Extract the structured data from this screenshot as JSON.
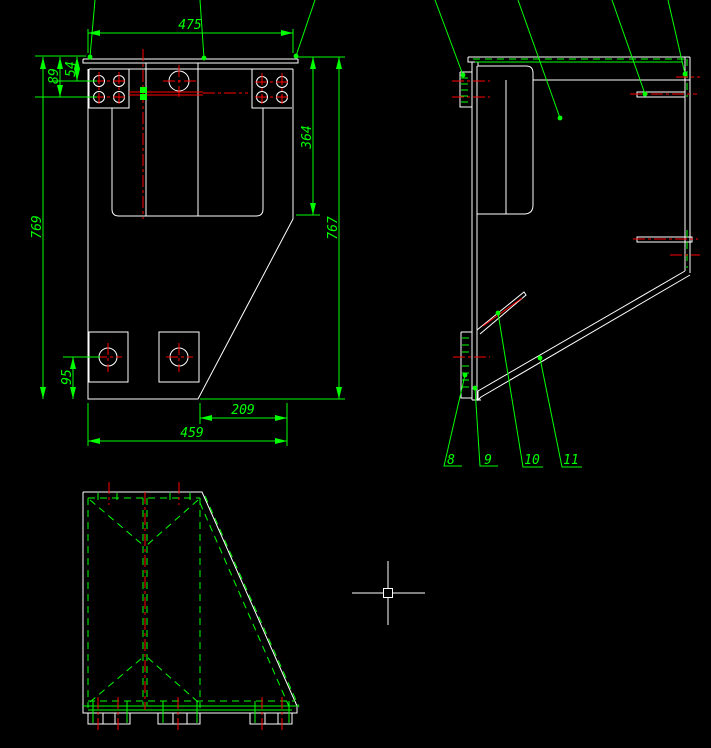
{
  "drawing": {
    "background": "#000000",
    "colors": {
      "geometry": "#ffffff",
      "annotation": "#00ff00",
      "centerline": "#ff0000"
    },
    "front_view": {
      "dims": {
        "top_width": "475",
        "hole_row1_offset": "54",
        "hole_row2_offset": "89",
        "overall_height_left": "769",
        "slot_depth": "364",
        "overall_height_right": "767",
        "pad_center_height": "95",
        "base_width": "459",
        "base_cut_width": "209"
      }
    },
    "side_view": {
      "callouts": [
        "8",
        "9",
        "10",
        "11"
      ]
    },
    "cursor": {
      "style": "crosshair-with-pickbox"
    }
  }
}
